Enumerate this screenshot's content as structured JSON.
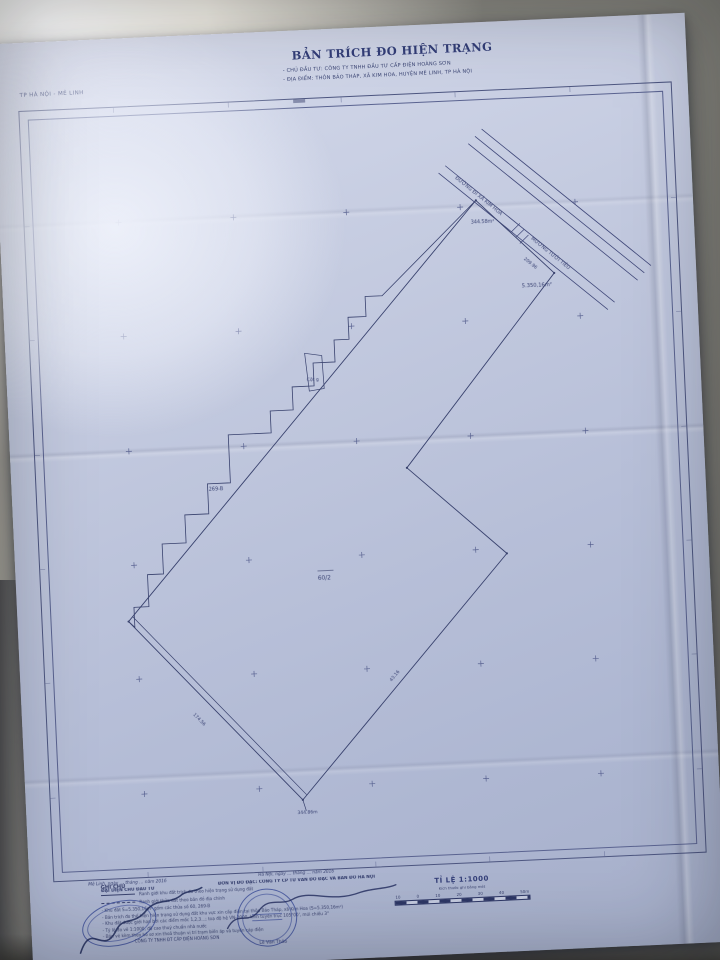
{
  "document": {
    "region_label": "TP HÀ NỘI - MÊ LINH",
    "title": "BẢN TRÍCH ĐO HIỆN TRẠNG",
    "investor_line": "- CHỦ ĐẦU TƯ: CÔNG TY TNHH ĐẦU TƯ CẤP ĐIỆN HOÀNG SƠN",
    "location_line": "- ĐỊA ĐIỂM:   THÔN BẢO THÁP, XÃ KIM HOA, HUYỆN MÊ LINH, TP HÀ NỘI"
  },
  "map": {
    "road_label_1": "ĐƯỜNG ĐI XÃ KIM HOA",
    "road_label_2": "MƯƠNG TƯỚI TIÊU",
    "area_label_small": "344.58m²",
    "dim_label": "209.96",
    "area_label_total": "5.350,16m²",
    "post_label": "Cột g",
    "plot_label": "269-B",
    "parcel_label": "60/2",
    "edge_label_sw": "174.56",
    "edge_label_se": "43.16",
    "vertex_label": "344.86m"
  },
  "legend": {
    "title": "GHI CHÚ",
    "items": [
      {
        "style": "solid",
        "text": "Ranh giới khu đất trích đo theo hiện trạng sử dụng đất"
      },
      {
        "style": "dashed",
        "text": "Ranh giới thửa đất theo bản đồ địa chính"
      }
    ],
    "notes": [
      "- Khu đất S=5.350,16m² gồm các thửa số 60, 269-B",
      "- Bản trích đo thể hiện hiện trạng sử dụng đất khu vực xin cấp điện tại thôn Bảo Tháp, xã Kim Hoa (S=5.350,16m²)",
      "- Khu đất được giới hạn bởi các điểm mốc 1,2,3…; toạ độ hệ VN-2000, kinh tuyến trục 105°00', múi chiếu 3°",
      "- Tỷ lệ đo vẽ 1:1000, độ cao thuỷ chuẩn nhà nước",
      "- Bản vẽ kèm theo hồ sơ xin thoả thuận vị trí trạm biến áp và tuyến cáp điện"
    ]
  },
  "footer": {
    "left": {
      "date_line": "Mê Linh, ngày … tháng … năm 2016",
      "org_line": "ĐẠI DIỆN CHỦ ĐẦU TƯ",
      "name_line": "CÔNG TY TNHH ĐT CẤP ĐIỆN HOÀNG SƠN"
    },
    "center": {
      "date_line": "Hà Nội, ngày … tháng … năm 2016",
      "org_line": "ĐƠN VỊ ĐO ĐẠC: CÔNG TY CP TƯ VẤN ĐO ĐẠC VÀ BẢN ĐỒ HÀ NỘI",
      "name_line": "Lê Văn Thảo"
    },
    "scale": {
      "label": "TỈ LỆ 1:1000",
      "sub_label": "Kích thước ghi bằng mét",
      "bar_labels": [
        "10",
        "0",
        "10",
        "20",
        "30",
        "40",
        "50m"
      ]
    }
  },
  "colors": {
    "ink": "#39426e",
    "paper": "#c2c8df"
  }
}
